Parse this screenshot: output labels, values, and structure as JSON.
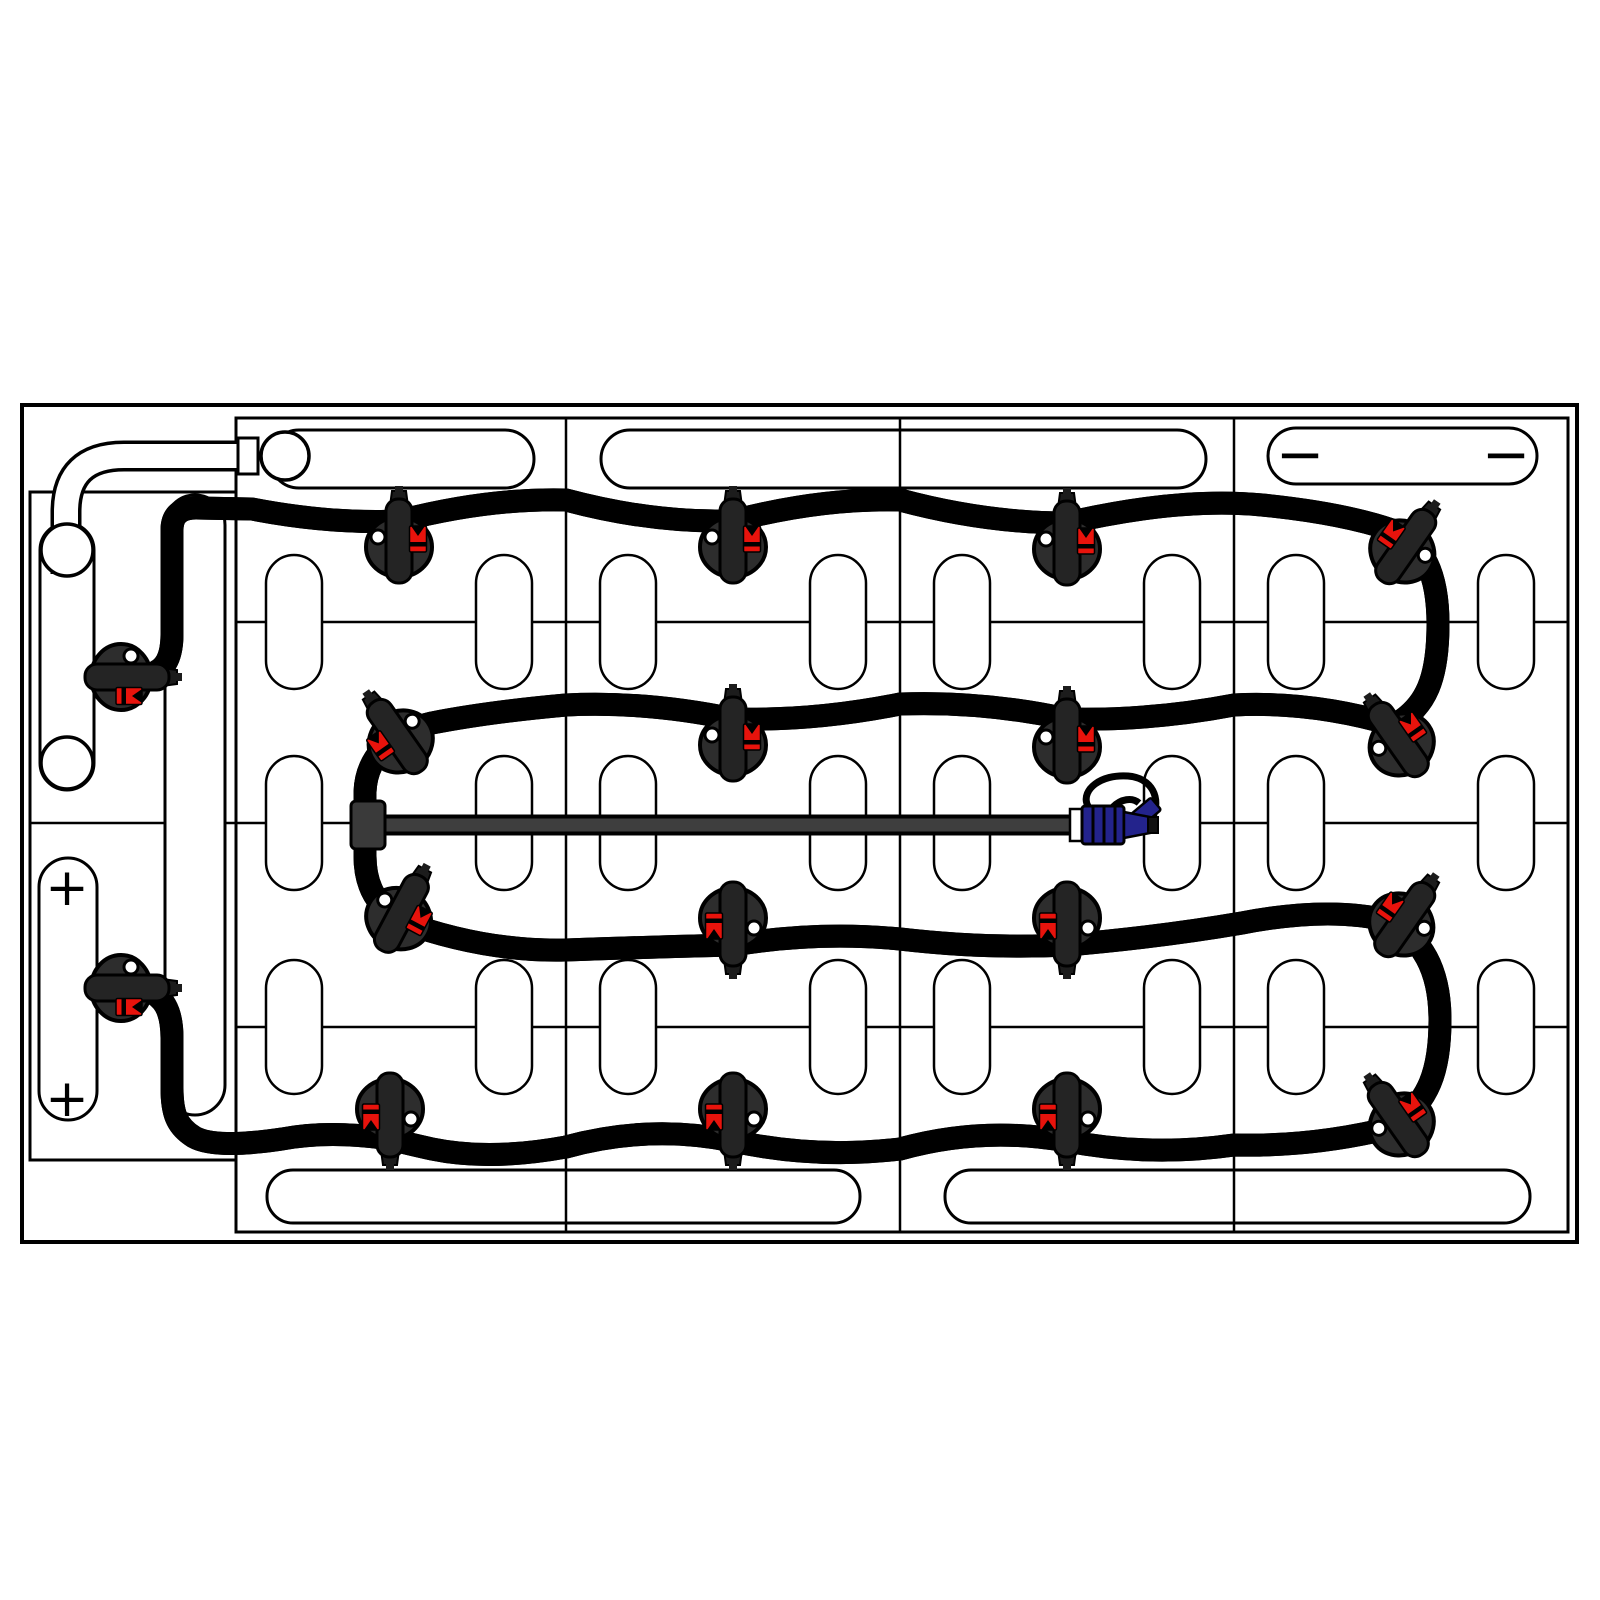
{
  "page": {
    "background": "#ffffff",
    "description": "Battery pack watering-system tubing layout diagram (top view)"
  },
  "labels": {
    "plus": "+",
    "minus": "−"
  },
  "colors": {
    "line": "#000000",
    "tube_fill": "#3e3e3e",
    "tube_outline": "#000000",
    "cable_fill": "#ffffff",
    "valve_body": "#2d2d2d",
    "valve_cap": "#242424",
    "valve_indicator_red": "#e8130c",
    "valve_dot_white": "#ffffff",
    "connector_blue": "#23238c",
    "cell_fill": "#ffffff"
  },
  "inventory": {
    "battery_cells": 18,
    "watering_valves": 18,
    "positive_terminal_marks": 2,
    "negative_terminal_marks": 2,
    "quick_connector": 1,
    "terminal_posts": 3
  },
  "valves": [
    {
      "x": 399,
      "y": 544,
      "r": 0,
      "f": 1
    },
    {
      "x": 733,
      "y": 544,
      "r": 0,
      "f": 1
    },
    {
      "x": 1067,
      "y": 546,
      "r": 0,
      "f": 1
    },
    {
      "x": 1404,
      "y": 549,
      "r": 35,
      "f": -1
    },
    {
      "x": 1400,
      "y": 742,
      "r": -35,
      "f": 1
    },
    {
      "x": 1067,
      "y": 744,
      "r": 0,
      "f": 1
    },
    {
      "x": 733,
      "y": 742,
      "r": 0,
      "f": 1
    },
    {
      "x": 399,
      "y": 739,
      "r": -35,
      "f": -1
    },
    {
      "x": 400,
      "y": 916,
      "r": 28,
      "f": 1
    },
    {
      "x": 733,
      "y": 921,
      "r": 180,
      "f": 1
    },
    {
      "x": 1067,
      "y": 921,
      "r": 180,
      "f": 1
    },
    {
      "x": 1403,
      "y": 922,
      "r": 35,
      "f": -1
    },
    {
      "x": 1400,
      "y": 1122,
      "r": -35,
      "f": 1
    },
    {
      "x": 1067,
      "y": 1112,
      "r": 180,
      "f": 1
    },
    {
      "x": 733,
      "y": 1112,
      "r": 180,
      "f": 1
    },
    {
      "x": 390,
      "y": 1112,
      "r": 180,
      "f": 1
    },
    {
      "x": 124,
      "y": 677,
      "r": 90,
      "f": 1
    },
    {
      "x": 124,
      "y": 988,
      "r": 90,
      "f": 1
    }
  ]
}
